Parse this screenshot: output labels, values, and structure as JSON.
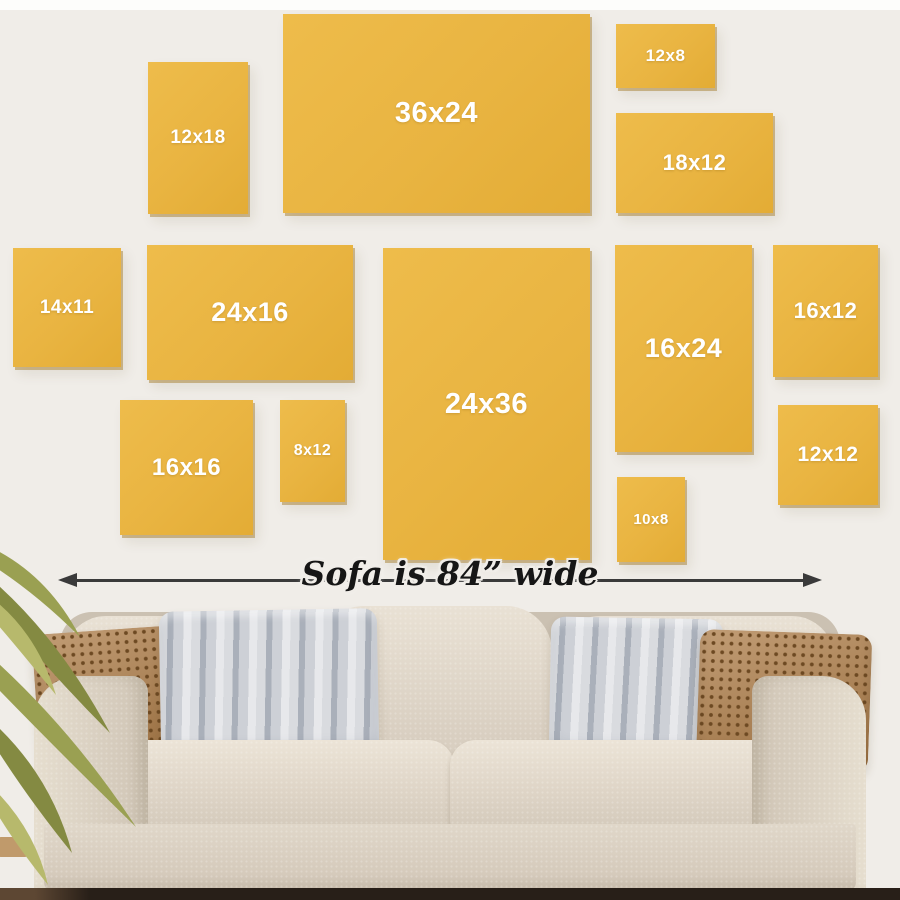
{
  "scene": {
    "wall_color": "#f0ede8",
    "top_band_color": "#fdfdfb",
    "floor_color": "#281f18"
  },
  "canvas_guide": {
    "tile_color": "#e9b441",
    "label_color": "#ffffff",
    "items": [
      {
        "label": "12x18",
        "x": 148,
        "y": 62,
        "w": 100,
        "h": 152,
        "font": 19
      },
      {
        "label": "36x24",
        "x": 283,
        "y": 14,
        "w": 307,
        "h": 199,
        "font": 29
      },
      {
        "label": "12x8",
        "x": 616,
        "y": 24,
        "w": 99,
        "h": 64,
        "font": 17
      },
      {
        "label": "18x12",
        "x": 616,
        "y": 113,
        "w": 157,
        "h": 100,
        "font": 22
      },
      {
        "label": "14x11",
        "x": 13,
        "y": 248,
        "w": 108,
        "h": 119,
        "font": 19
      },
      {
        "label": "24x16",
        "x": 147,
        "y": 245,
        "w": 206,
        "h": 135,
        "font": 27
      },
      {
        "label": "24x36",
        "x": 383,
        "y": 248,
        "w": 207,
        "h": 312,
        "font": 29
      },
      {
        "label": "16x24",
        "x": 615,
        "y": 245,
        "w": 137,
        "h": 207,
        "font": 27
      },
      {
        "label": "16x12",
        "x": 773,
        "y": 245,
        "w": 105,
        "h": 132,
        "font": 22
      },
      {
        "label": "16x16",
        "x": 120,
        "y": 400,
        "w": 133,
        "h": 135,
        "font": 24
      },
      {
        "label": "8x12",
        "x": 280,
        "y": 400,
        "w": 65,
        "h": 102,
        "font": 16
      },
      {
        "label": "12x12",
        "x": 778,
        "y": 405,
        "w": 100,
        "h": 100,
        "font": 21
      },
      {
        "label": "10x8",
        "x": 617,
        "y": 477,
        "w": 68,
        "h": 85,
        "font": 15
      }
    ]
  },
  "measure": {
    "label": "Sofa is 84” wide",
    "line_color": "#3a3a3a"
  },
  "sofa": {
    "fabric_color": "#ddd4c6",
    "pillow_brown_color": "#ad7c47",
    "pillow_brown_dot_color": "#6d4922",
    "pillow_gray_stripe_color": "#aab0ba"
  },
  "plant": {
    "leaf_color": "#9aa052",
    "leaf_light_color": "#b7b96c",
    "leaf_dark_color": "#7f8442",
    "pot_color": "#c09a6b"
  }
}
